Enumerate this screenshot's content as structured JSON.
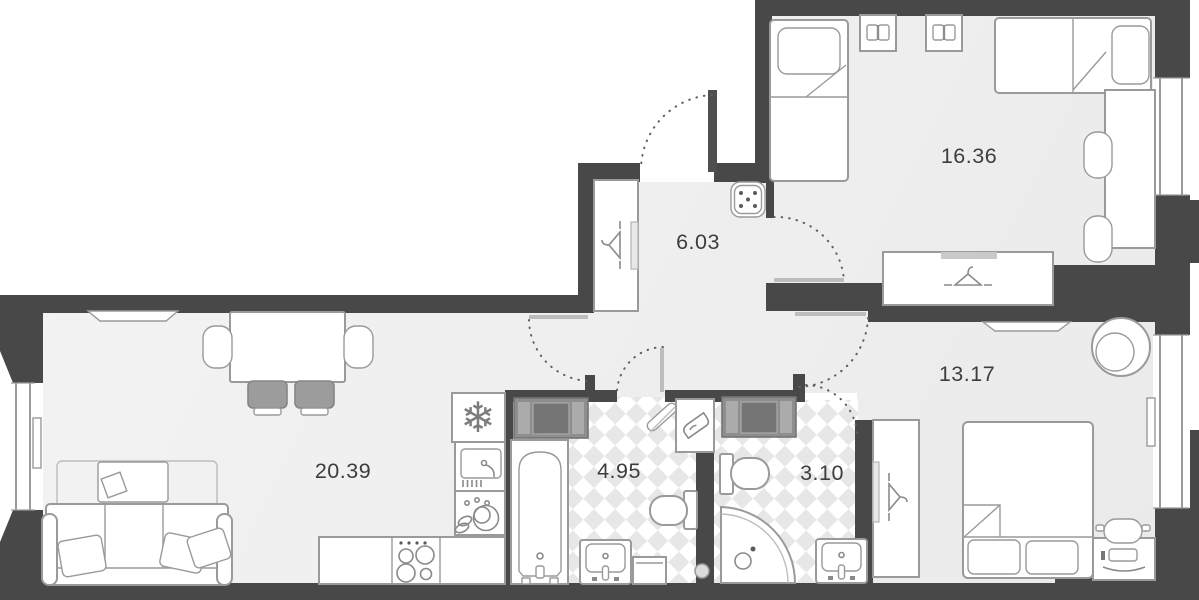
{
  "colors": {
    "wall": "#484848",
    "floor-a": "#f3f3f3",
    "floor-b": "#e9e9e9",
    "tile": "#e7e7e7",
    "line": "#9a9a9a",
    "line-soft": "#bdbdbd",
    "arc": "#5f5f5f",
    "text": "#3d3d3d",
    "washer": "#8e8e8e",
    "washer-dark": "#757575",
    "washer-light": "#ababab",
    "seat": "#9c9c9c"
  },
  "rooms": [
    {
      "id": "bedroom-1",
      "area": "16.36"
    },
    {
      "id": "hallway",
      "area": "6.03"
    },
    {
      "id": "bedroom-2",
      "area": "13.17"
    },
    {
      "id": "living-kitchen",
      "area": "20.39"
    },
    {
      "id": "bathroom",
      "area": "4.95"
    },
    {
      "id": "wc",
      "area": "3.10"
    }
  ],
  "icons": {
    "fridge": "snowflake-icon",
    "wardrobes": "hanger-icon",
    "nightstands": "open-book-icon",
    "laundry-corner": "iron-icon",
    "utility-panel": "five-dots-icon"
  }
}
